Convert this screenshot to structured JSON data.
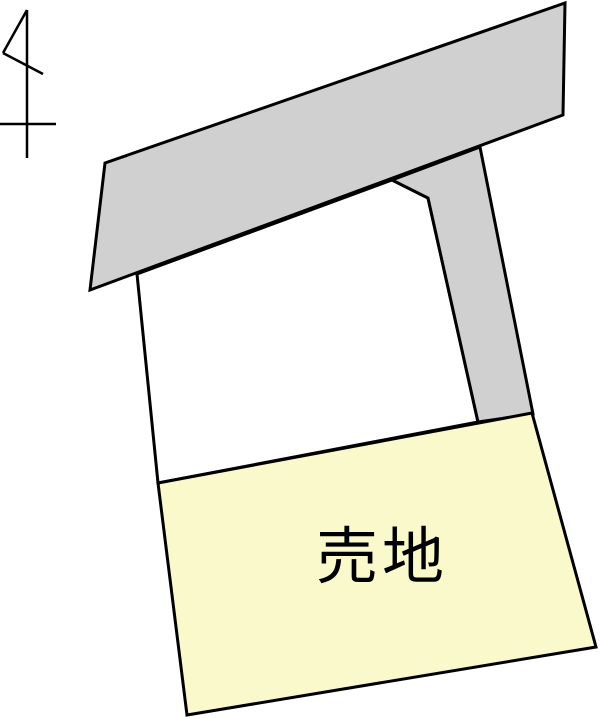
{
  "canvas": {
    "width": 600,
    "height": 718,
    "background": "#ffffff"
  },
  "colors": {
    "outline": "#000000",
    "road_fill": "#d0d0d0",
    "sale_parcel_fill": "#faf9cc",
    "neighbor_parcel_fill": "#ffffff",
    "label_color": "#000000"
  },
  "labels": {
    "sale_parcel": "売地"
  },
  "north_arrow": {
    "stroke_width": 2.5,
    "segments": [
      [
        27,
        10,
        3,
        53
      ],
      [
        3,
        53,
        43,
        74
      ],
      [
        27,
        10,
        27,
        158
      ],
      [
        0,
        124,
        56,
        124
      ]
    ]
  },
  "shapes": [
    {
      "name": "neighbor-parcel",
      "fill": "#ffffff",
      "stroke_width": 3,
      "points": [
        [
          137,
          274
        ],
        [
          392,
          180
        ],
        [
          428,
          198
        ],
        [
          478,
          422
        ],
        [
          158,
          483
        ]
      ]
    },
    {
      "name": "side-road",
      "fill": "#d0d0d0",
      "stroke_width": 3,
      "points": [
        [
          392,
          180
        ],
        [
          480,
          147
        ],
        [
          533,
          414
        ],
        [
          478,
          422
        ],
        [
          428,
          198
        ]
      ]
    },
    {
      "name": "top-road",
      "fill": "#d0d0d0",
      "stroke_width": 3,
      "points": [
        [
          105,
          163
        ],
        [
          565,
          3
        ],
        [
          563,
          115
        ],
        [
          90,
          290
        ]
      ]
    },
    {
      "name": "sale-parcel",
      "fill": "#faf9cc",
      "stroke_width": 3,
      "points": [
        [
          158,
          483
        ],
        [
          532,
          413
        ],
        [
          596,
          647
        ],
        [
          187,
          715
        ]
      ]
    }
  ]
}
